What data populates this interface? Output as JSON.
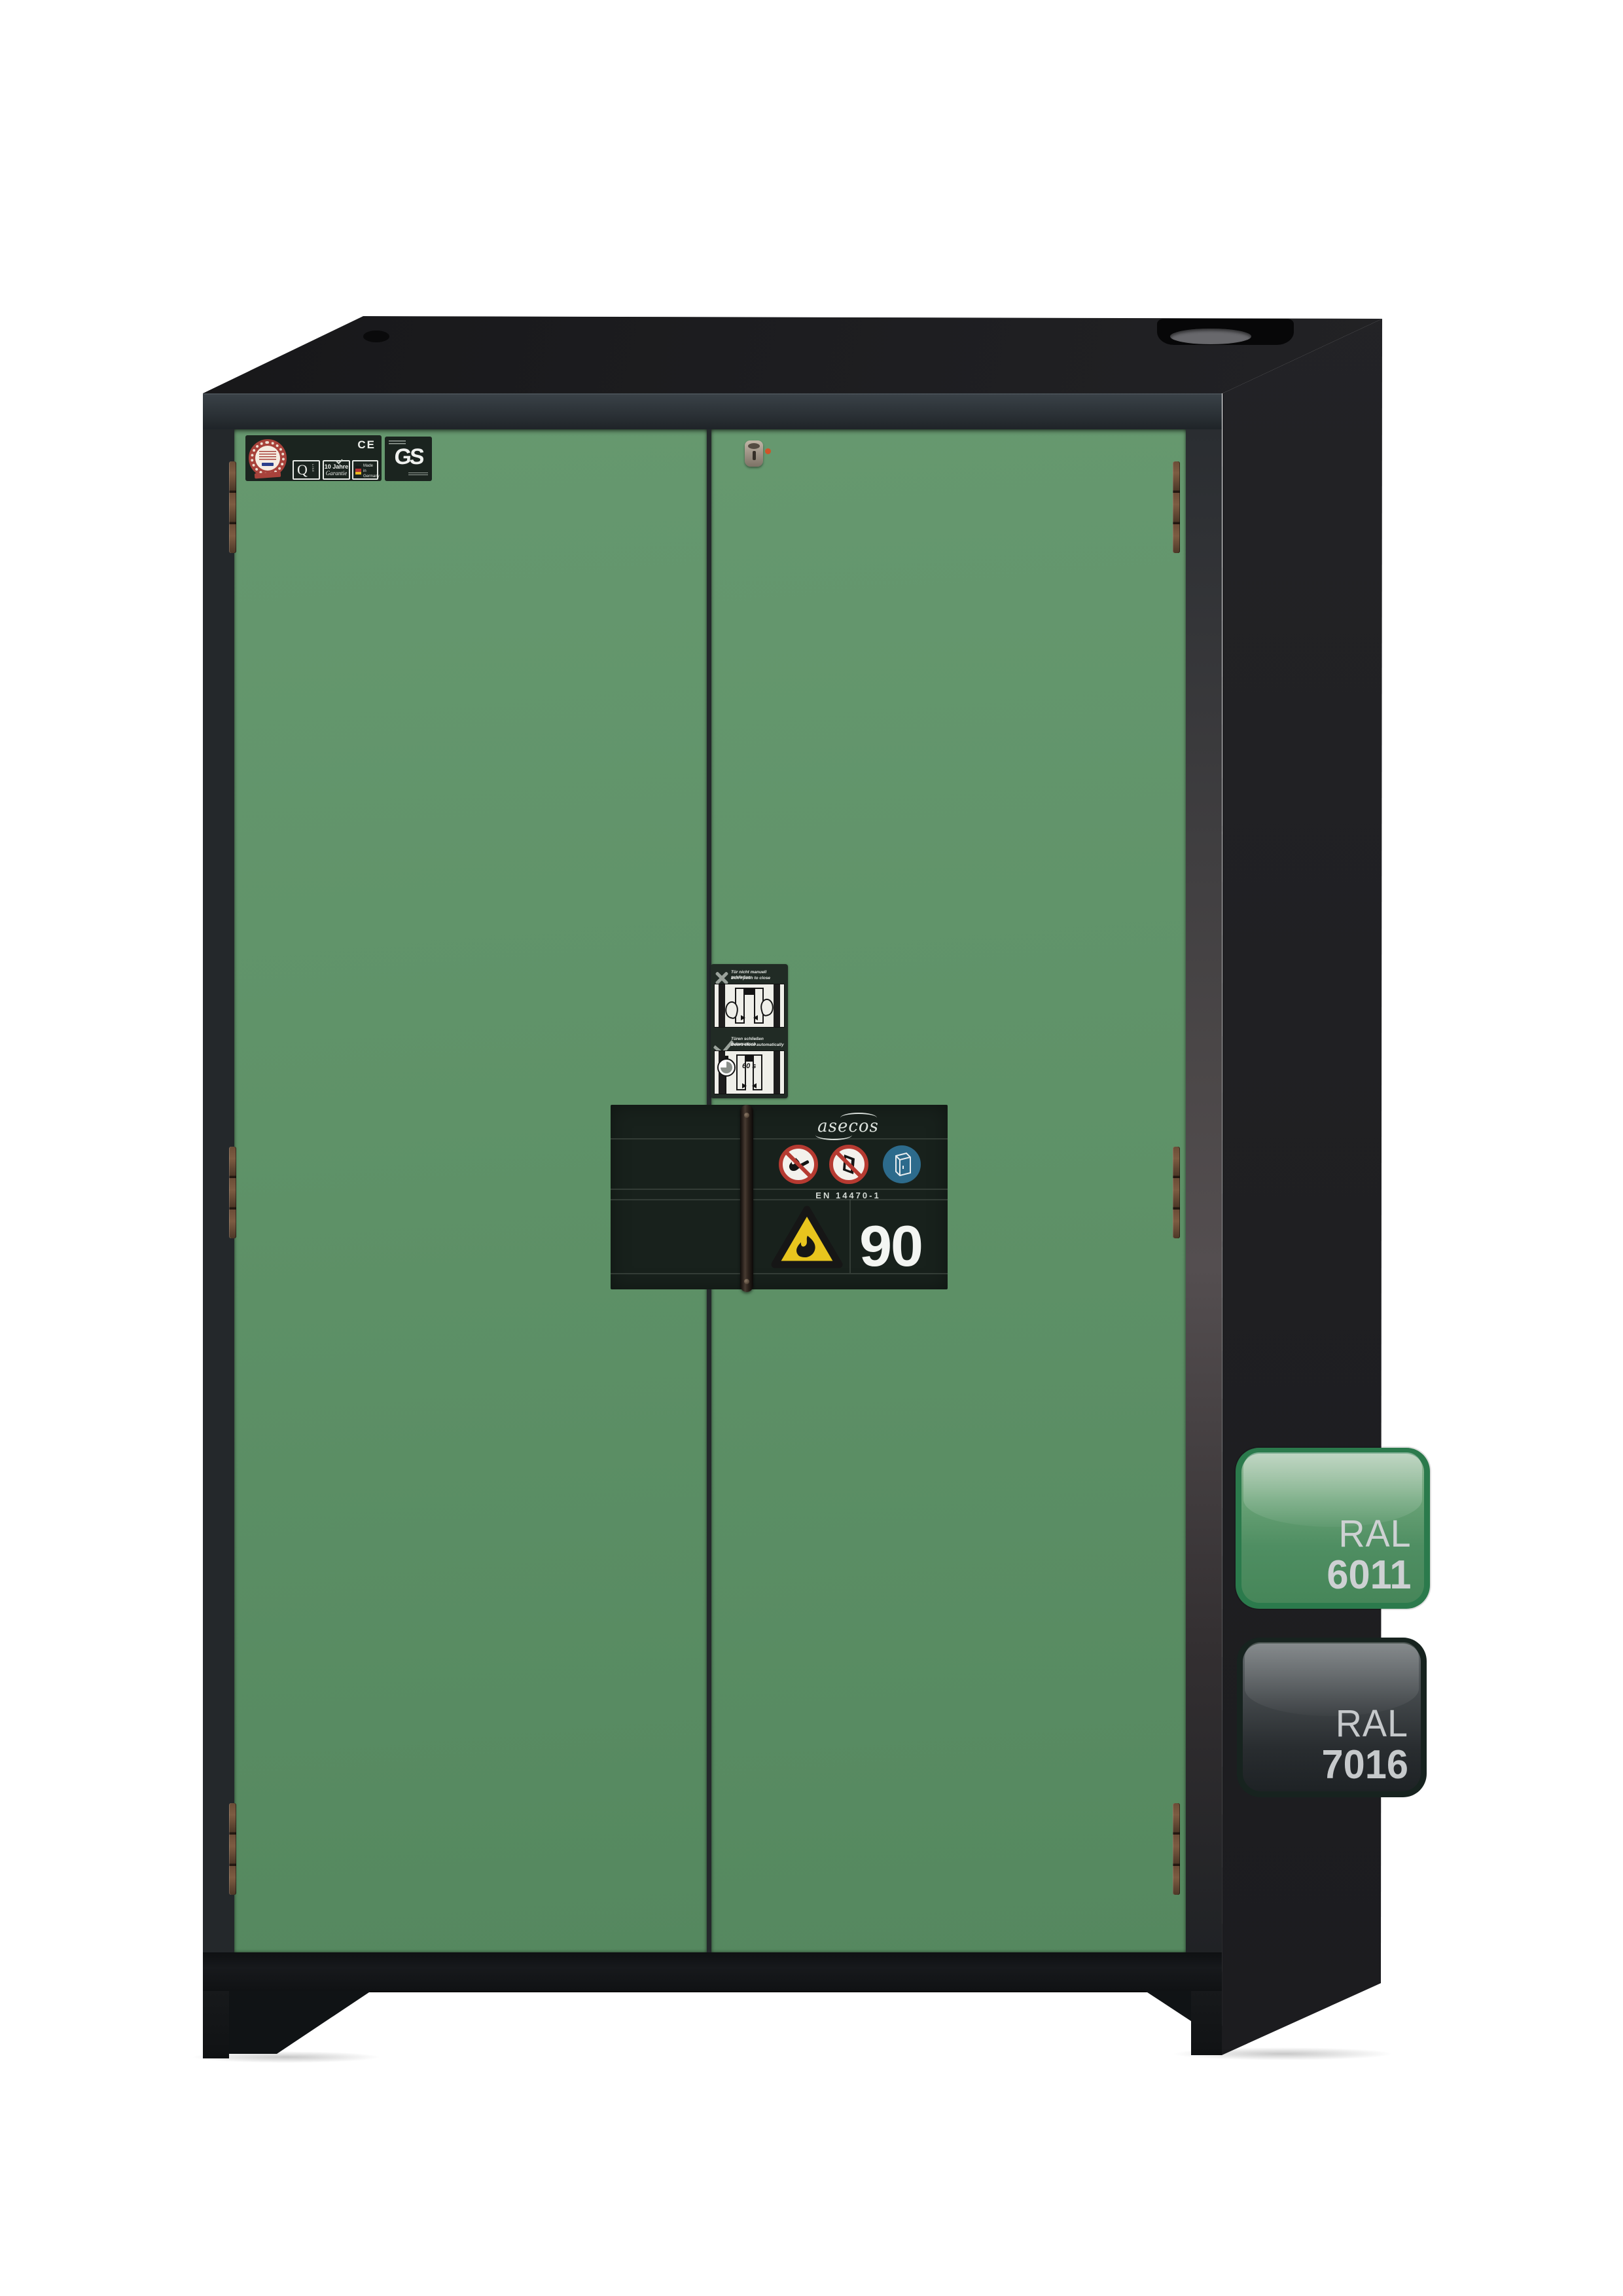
{
  "palette": {
    "background": "#ffffff",
    "door_green_ral6011": "#5f9268",
    "body_anthracite_ral7016": "#202023",
    "type_plate_background": "#18211c",
    "warning_yellow": "#e8c51e",
    "prohibition_red": "#b63a31",
    "mandatory_blue": "#2d6b8c",
    "badge_green_border": "#2b7a4c",
    "badge_grey_border": "#17231f"
  },
  "cert_strip": {
    "ce_mark": "CE",
    "q_line": "Q",
    "q_line_sub": "LINE",
    "warranty_line1": "10 Jahre",
    "warranty_line2": "Garantie",
    "made_in": {
      "l1": "Made",
      "l2": "in",
      "l3": "Germany"
    },
    "gs_mark": "GS"
  },
  "door_sticker": {
    "dont_de": "Tür nicht manuell schließen",
    "dont_en": "Don't push to close",
    "auto_de": "Türen schließen automatisch",
    "auto_en": "Doors close automatically",
    "timer": "60 s"
  },
  "type_plate": {
    "brand": "asecos",
    "standard": "EN 14470-1",
    "fire_rating": "90"
  },
  "color_badges": [
    {
      "label": "RAL",
      "code": "6011"
    },
    {
      "label": "RAL",
      "code": "7016"
    }
  ]
}
